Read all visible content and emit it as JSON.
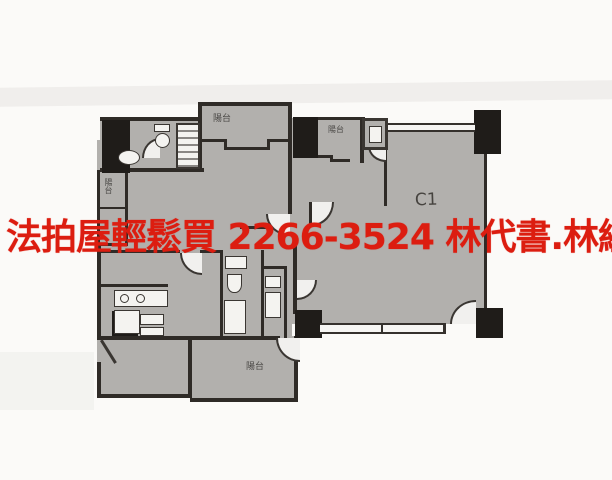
{
  "watermark": {
    "slogan": "法拍屋輕鬆買",
    "phone": "2266-3524",
    "contact": "林代書.林經理",
    "full_text": "法拍屋輕鬆買  2266-3524  林代書.林經理",
    "color": "#dc1d10"
  },
  "floor_plan": {
    "unit_label": "C1",
    "labels": {
      "balcony_top": "陽台",
      "balcony_mid": "陽台",
      "balcony_bottom": "陽台",
      "shaft": "陽台"
    },
    "colors": {
      "room_fill": "#b2b0ad",
      "wall": "#2f2b27",
      "column": "#1f1c19",
      "paper": "#fbfaf8",
      "fixture": "#f4f3f0"
    }
  }
}
